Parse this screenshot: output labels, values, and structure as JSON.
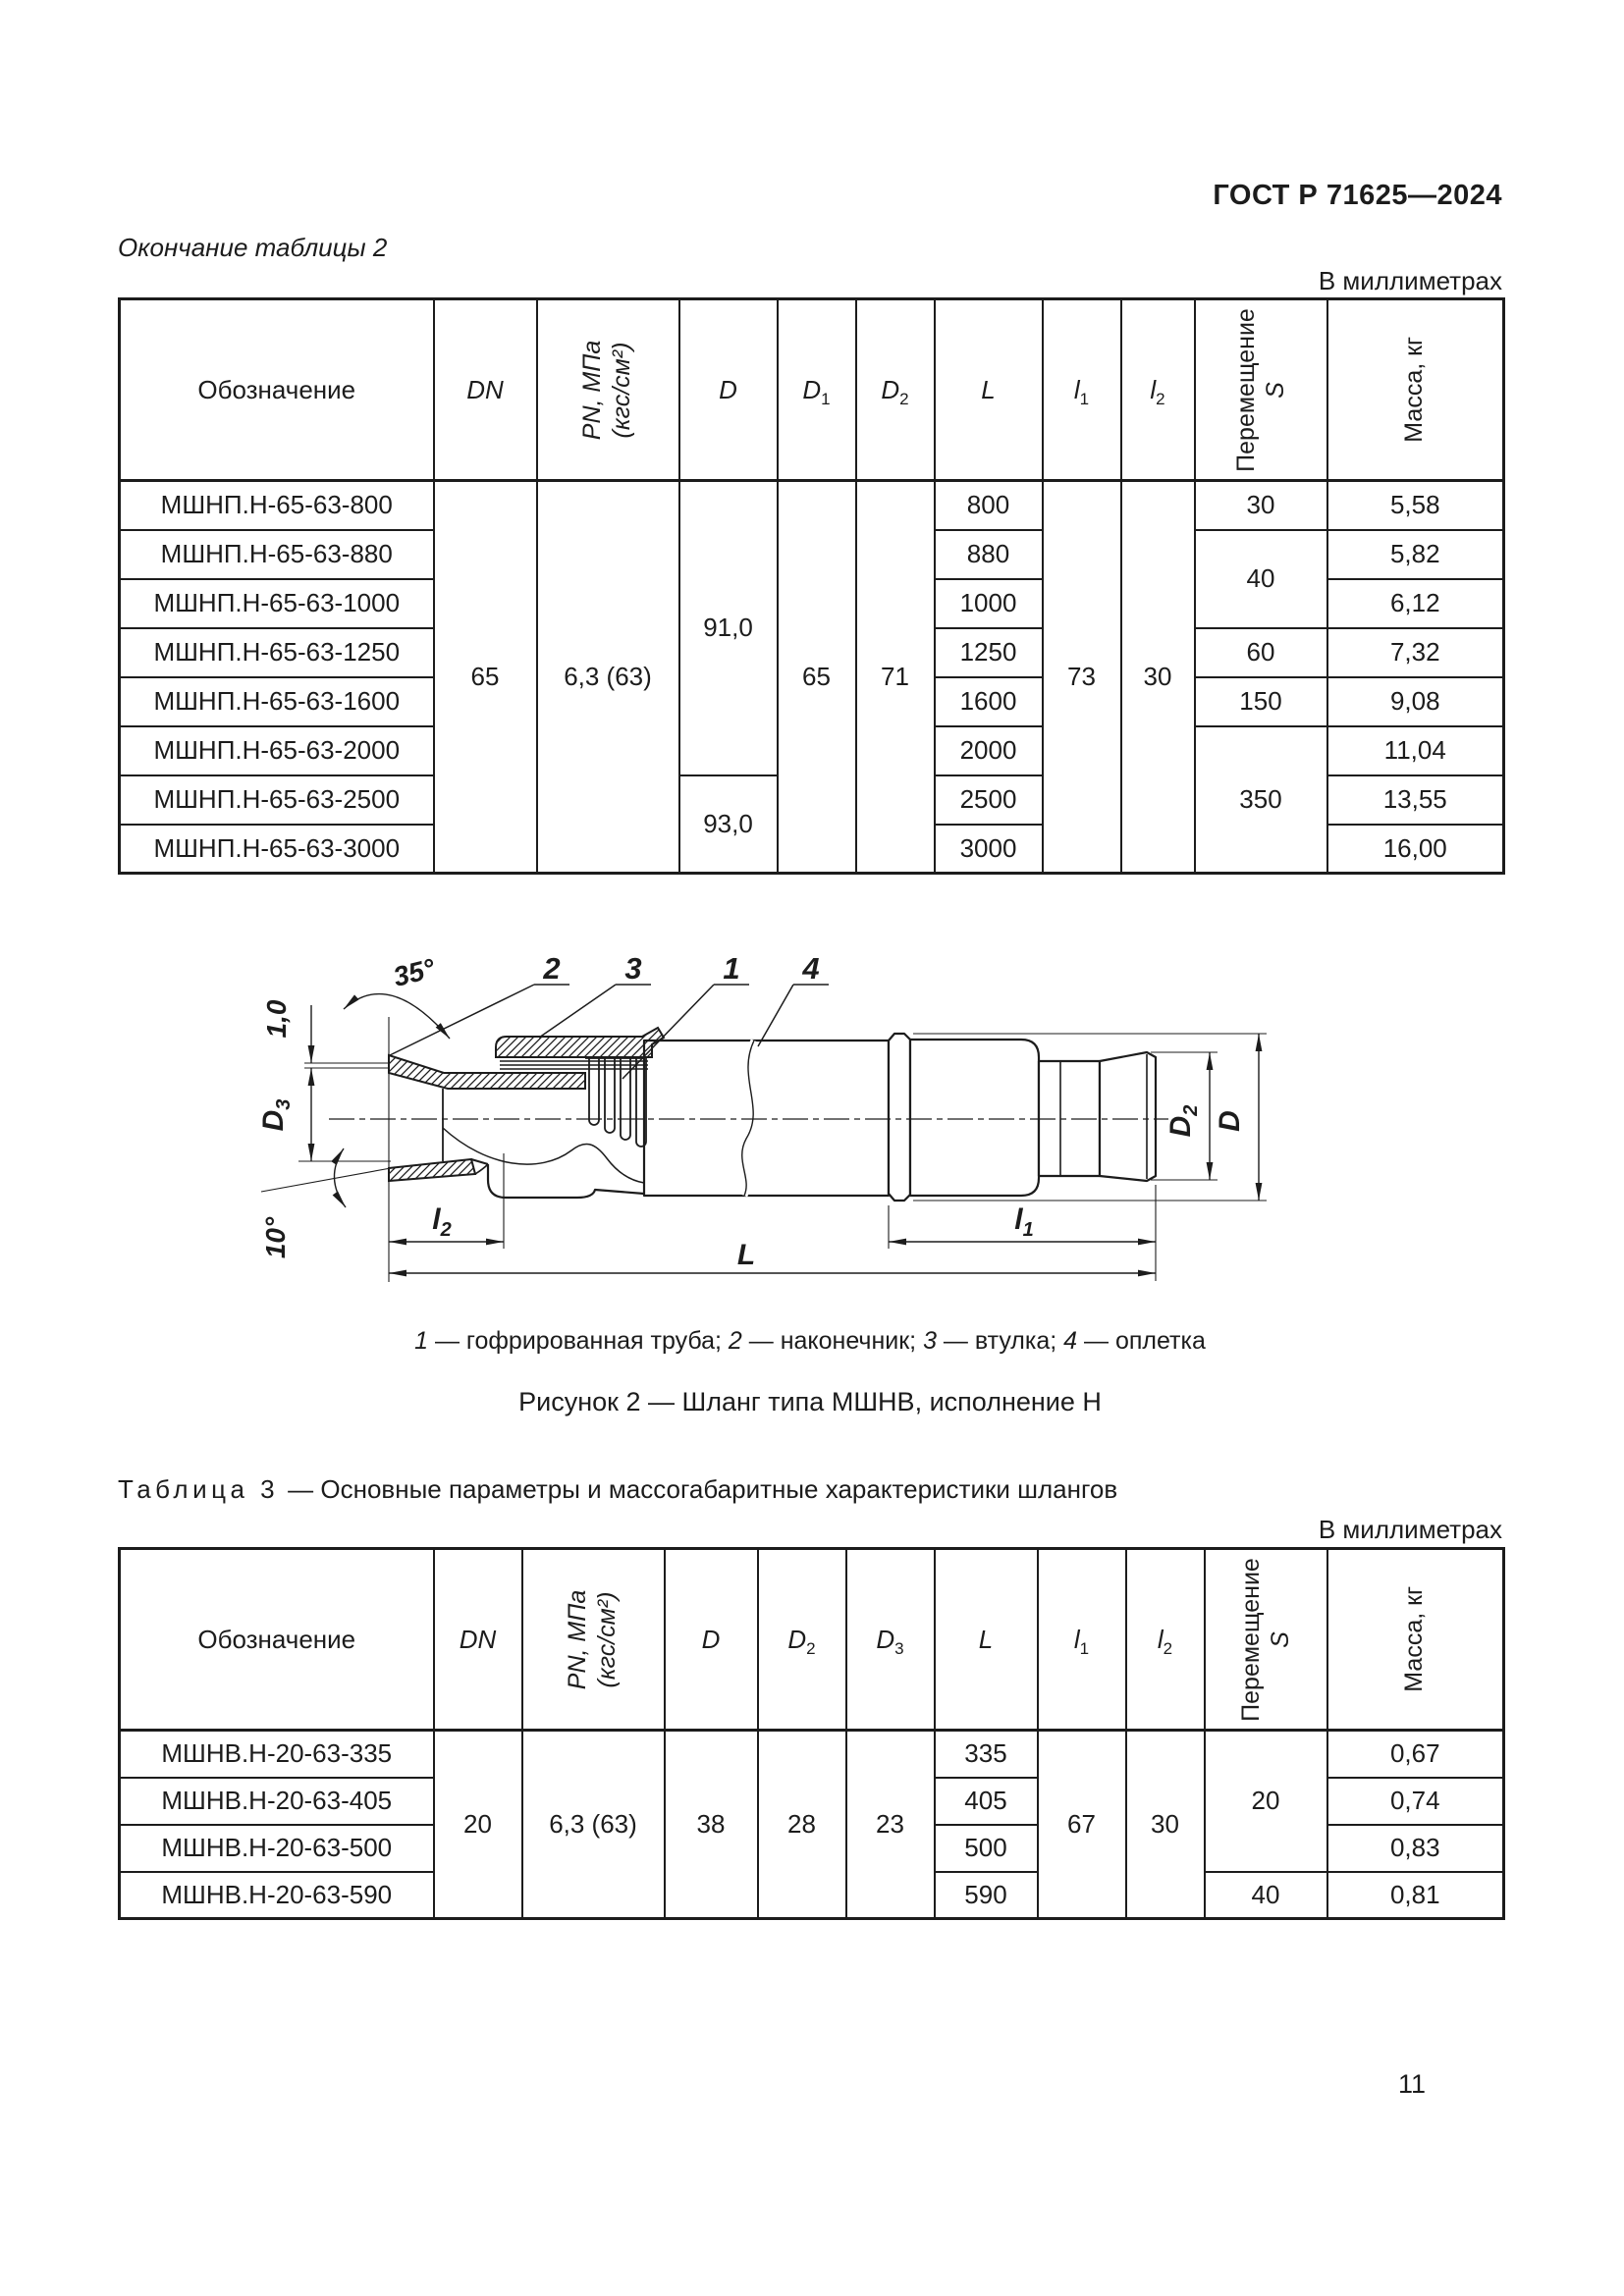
{
  "page": {
    "standard": "ГОСТ Р 71625—2024",
    "number": "11"
  },
  "table2_block": {
    "continuation_label": "Окончание таблицы 2",
    "units_note": "В миллиметрах",
    "headers": {
      "designation": "Обозначение",
      "dn": "DN",
      "pn": "PN, МПа\n(кгс/см²)",
      "d": "D",
      "d1_base": "D",
      "d1_sub": "1",
      "d2_base": "D",
      "d2_sub": "2",
      "l": "L",
      "l1_base": "l",
      "l1_sub": "1",
      "l2_base": "l",
      "l2_sub": "2",
      "s_line1": "Перемещение",
      "s_line2": "S",
      "mass": "Масса, кг"
    },
    "rows": [
      {
        "designation": "МШНП.Н-65-63-800",
        "dn": "65",
        "pn": "6,3 (63)",
        "d": "91,0",
        "d1": "65",
        "d2": "71",
        "l": "800",
        "l1": "73",
        "l2": "30",
        "s": "30",
        "mass": "5,58"
      },
      {
        "designation": "МШНП.Н-65-63-880",
        "l": "880",
        "s": "40",
        "mass": "5,82"
      },
      {
        "designation": "МШНП.Н-65-63-1000",
        "l": "1000",
        "mass": "6,12"
      },
      {
        "designation": "МШНП.Н-65-63-1250",
        "l": "1250",
        "s": "60",
        "mass": "7,32"
      },
      {
        "designation": "МШНП.Н-65-63-1600",
        "l": "1600",
        "s": "150",
        "mass": "9,08"
      },
      {
        "designation": "МШНП.Н-65-63-2000",
        "l": "2000",
        "s": "350",
        "mass": "11,04"
      },
      {
        "designation": "МШНП.Н-65-63-2500",
        "d": "93,0",
        "l": "2500",
        "mass": "13,55"
      },
      {
        "designation": "МШНП.Н-65-63-3000",
        "l": "3000",
        "mass": "16,00"
      }
    ]
  },
  "figure": {
    "callouts": [
      "2",
      "3",
      "1",
      "4"
    ],
    "labels": {
      "angle35": "35°",
      "thickness": "1,0",
      "d3_base": "D",
      "d3_sub": "3",
      "angle10": "10°",
      "l2_base": "l",
      "l2_sub": "2",
      "L": "L",
      "l1_base": "l",
      "l1_sub": "1",
      "d2_base": "D",
      "d2_sub": "2",
      "d": "D"
    },
    "legend": [
      {
        "num": "1",
        "text": " — гофрированная труба; "
      },
      {
        "num": "2",
        "text": " — наконечник; "
      },
      {
        "num": "3",
        "text": " — втулка; "
      },
      {
        "num": "4",
        "text": " — оплетка"
      }
    ],
    "caption": "Рисунок 2 — Шланг типа МШНВ, исполнение Н"
  },
  "table3_block": {
    "label": "Таблица 3",
    "title": "— Основные параметры и массогабаритные характеристики шлангов",
    "units_note": "В миллиметрах",
    "headers": {
      "designation": "Обозначение",
      "dn": "DN",
      "pn": "PN, МПа\n(кгс/см²)",
      "d": "D",
      "d2_base": "D",
      "d2_sub": "2",
      "d3_base": "D",
      "d3_sub": "3",
      "l": "L",
      "l1_base": "l",
      "l1_sub": "1",
      "l2_base": "l",
      "l2_sub": "2",
      "s_line1": "Перемещение",
      "s_line2": "S",
      "mass": "Масса, кг"
    },
    "rows": [
      {
        "designation": "МШНВ.Н-20-63-335",
        "dn": "20",
        "pn": "6,3 (63)",
        "d": "38",
        "d2": "28",
        "d3": "23",
        "l": "335",
        "l1": "67",
        "l2": "30",
        "s": "20",
        "mass": "0,67"
      },
      {
        "designation": "МШНВ.Н-20-63-405",
        "l": "405",
        "mass": "0,74"
      },
      {
        "designation": "МШНВ.Н-20-63-500",
        "l": "500",
        "mass": "0,83"
      },
      {
        "designation": "МШНВ.Н-20-63-590",
        "l": "590",
        "s": "40",
        "mass": "0,81"
      }
    ]
  }
}
